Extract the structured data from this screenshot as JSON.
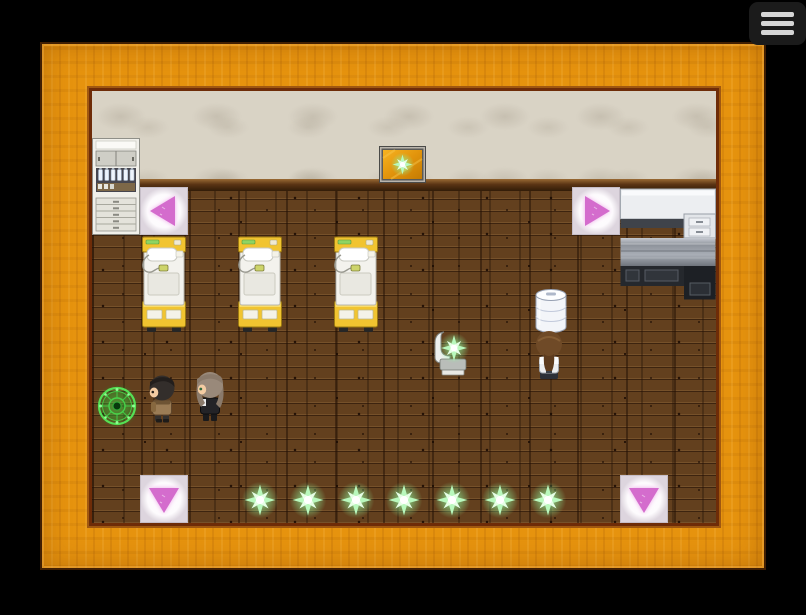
{
  "menu": {
    "name": "hamburger-menu",
    "icon": "hamburger-icon",
    "bar_count": 3
  },
  "palette": {
    "background": "#000000",
    "frame_wood": "#e6930e",
    "frame_border": "#401e02",
    "frame_inner_line": "#6e2c08",
    "wall": "#d9d3c5",
    "floor": "#63401e",
    "arrow_pink": "#d46ccd",
    "arrow_glow": "#eda7e8",
    "star_green": "#8df79c",
    "star_ray": "#b9f8bd",
    "magic_green": "#46e04c",
    "bed_yellow": "#f1c430",
    "bed_trim": "#9c7a12",
    "menu_bg": "#1b1b1b",
    "menu_bar": "#d6d6d6"
  },
  "scene": {
    "tile_size": 48,
    "entities": [
      {
        "type": "cabinet",
        "name": "medicine-cabinet",
        "x": 0,
        "y": 47,
        "w": 48,
        "h": 97,
        "interactable": false
      },
      {
        "type": "wall-hatch",
        "name": "wall-hatch-sparkle",
        "x": 287,
        "y": 55,
        "w": 47,
        "h": 37,
        "interactable": true
      },
      {
        "type": "arrow",
        "dir": "left",
        "name": "teleport-pad-left",
        "x": 48,
        "y": 96,
        "w": 48,
        "h": 48,
        "interactable": true
      },
      {
        "type": "arrow",
        "dir": "right",
        "name": "teleport-pad-right",
        "x": 480,
        "y": 96,
        "w": 48,
        "h": 48,
        "interactable": true
      },
      {
        "type": "desk",
        "name": "reception-desk",
        "x": 528,
        "y": 97,
        "w": 96,
        "h": 112,
        "interactable": false
      },
      {
        "type": "bed",
        "name": "hospital-bed-1",
        "x": 48,
        "y": 144,
        "w": 48,
        "h": 98,
        "interactable": false
      },
      {
        "type": "bed",
        "name": "hospital-bed-2",
        "x": 144,
        "y": 144,
        "w": 48,
        "h": 98,
        "interactable": false
      },
      {
        "type": "bed",
        "name": "hospital-bed-3",
        "x": 240,
        "y": 144,
        "w": 48,
        "h": 98,
        "interactable": false
      },
      {
        "type": "cylinder",
        "name": "water-tank",
        "x": 441,
        "y": 196,
        "w": 36,
        "h": 46,
        "interactable": false
      },
      {
        "type": "chair",
        "name": "chair-with-sparkle",
        "x": 336,
        "y": 238,
        "w": 48,
        "h": 48,
        "interactable": true
      },
      {
        "type": "magic-circle",
        "name": "save-point-circle",
        "x": 2,
        "y": 292,
        "w": 46,
        "h": 46,
        "interactable": true
      },
      {
        "type": "arrow",
        "dir": "down",
        "name": "teleport-pad-down-left",
        "x": 48,
        "y": 384,
        "w": 48,
        "h": 48,
        "interactable": true
      },
      {
        "type": "arrow",
        "dir": "down",
        "name": "teleport-pad-down-right",
        "x": 528,
        "y": 384,
        "w": 48,
        "h": 48,
        "interactable": true
      },
      {
        "type": "sparkle",
        "name": "sparkle-item-1",
        "x": 148,
        "y": 389,
        "w": 40,
        "h": 40,
        "interactable": true
      },
      {
        "type": "sparkle",
        "name": "sparkle-item-2",
        "x": 196,
        "y": 389,
        "w": 40,
        "h": 40,
        "interactable": true
      },
      {
        "type": "sparkle",
        "name": "sparkle-item-3",
        "x": 244,
        "y": 389,
        "w": 40,
        "h": 40,
        "interactable": true
      },
      {
        "type": "sparkle",
        "name": "sparkle-item-4",
        "x": 292,
        "y": 389,
        "w": 40,
        "h": 40,
        "interactable": true
      },
      {
        "type": "sparkle",
        "name": "sparkle-item-5",
        "x": 340,
        "y": 389,
        "w": 40,
        "h": 40,
        "interactable": true
      },
      {
        "type": "sparkle",
        "name": "sparkle-item-6",
        "x": 388,
        "y": 389,
        "w": 40,
        "h": 40,
        "interactable": true
      },
      {
        "type": "sparkle",
        "name": "sparkle-item-7",
        "x": 436,
        "y": 389,
        "w": 40,
        "h": 40,
        "interactable": true
      },
      {
        "type": "man",
        "name": "npc-man",
        "x": 50,
        "y": 282,
        "w": 40,
        "h": 52,
        "interactable": true
      },
      {
        "type": "woman",
        "name": "npc-woman",
        "x": 97,
        "y": 278,
        "w": 42,
        "h": 56,
        "interactable": true
      },
      {
        "type": "nurse",
        "name": "npc-nurse",
        "x": 437,
        "y": 238,
        "w": 40,
        "h": 52,
        "interactable": true
      }
    ]
  }
}
